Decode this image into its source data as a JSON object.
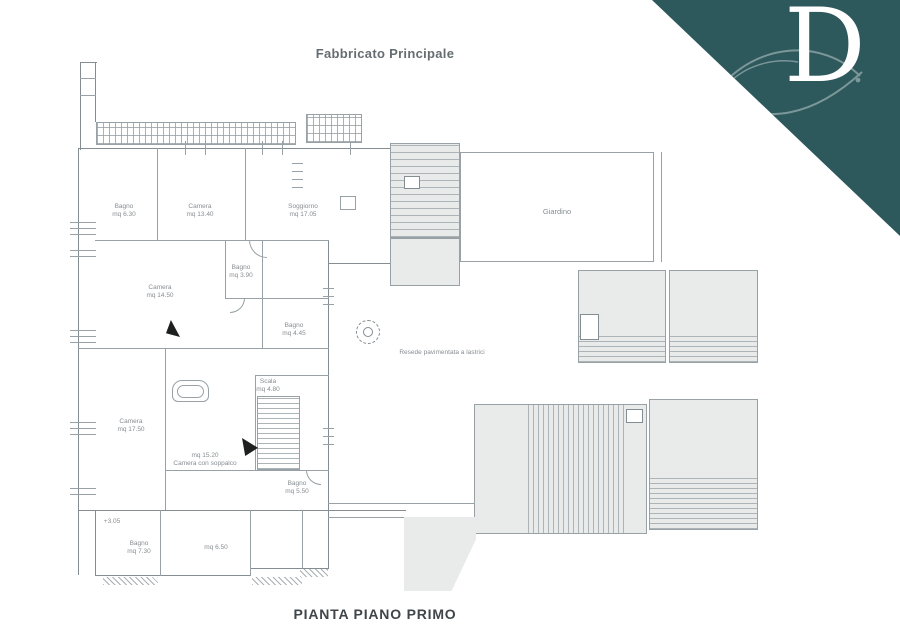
{
  "titles": {
    "top": "Fabbricato Principale",
    "bottom": "PIANTA PIANO PRIMO"
  },
  "logo": {
    "letter": "D",
    "bg_color": "#2d585c",
    "fg_color": "#ffffff"
  },
  "colors": {
    "plan_line": "#98a1a5",
    "plan_fill": "#e9ebea",
    "label_text": "#878e92"
  },
  "plan": {
    "labels": {
      "bagno1": {
        "l1": "Bagno",
        "l2": "mq 6.30"
      },
      "camera1": {
        "l1": "Camera",
        "l2": "mq 13.40"
      },
      "soggiorno": {
        "l1": "Soggiorno",
        "l2": "mq 17.05"
      },
      "camera2": {
        "l1": "Camera",
        "l2": "mq 14.50"
      },
      "bagno2": {
        "l1": "Bagno",
        "l2": "mq 3.90"
      },
      "bagno3": {
        "l1": "Bagno",
        "l2": "mq 4.45"
      },
      "camera3": {
        "l1": "Camera",
        "l2": "mq 17.50"
      },
      "soppalco": {
        "l1": "mq 15.20",
        "l2": "Camera con soppalco"
      },
      "scala": {
        "l1": "Scala",
        "l2": "mq 4.80"
      },
      "bagno4": {
        "l1": "Bagno",
        "l2": "mq 5.50"
      },
      "bagno5": {
        "l1": "Bagno",
        "l2": "mq 7.30"
      },
      "ripostiglio": {
        "l1": "mq 6.50"
      },
      "quota": {
        "l1": "+3.05"
      },
      "giardino": {
        "l1": "Giardino"
      },
      "resede": {
        "l1": "Resede pavimentata a lastrici"
      }
    }
  }
}
